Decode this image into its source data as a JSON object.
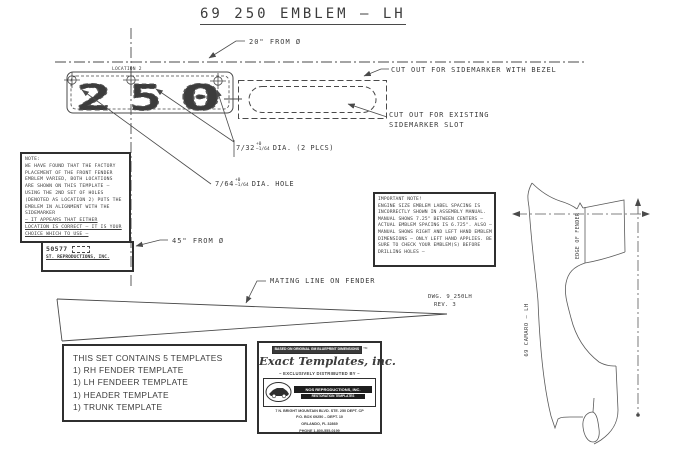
{
  "title": "69 250 EMBLEM  –  LH",
  "labels": {
    "from20": "20\" FROM Ø",
    "from45": "45\" FROM Ø",
    "location": "LOCATION 2",
    "cut_bezel": "CUT OUT FOR SIDEMARKER WITH BEZEL",
    "cut_existing1": "CUT OUT FOR EXISTING",
    "cut_existing2": "SIDEMARKER SLOT",
    "mating": "MATING LINE ON FENDER",
    "edge_of_fender": "EDGE OF FENDER",
    "camaro_lh": "69 CAMARO – LH"
  },
  "digits": {
    "d1": "2",
    "d2": "5",
    "d3": "0"
  },
  "dia2": {
    "frac": "7/32",
    "plus": "+0",
    "minus": "−1/64",
    "rest": "DIA. (2 PLCS)"
  },
  "dia1": {
    "frac": "7/64",
    "plus": "+0",
    "minus": "−1/64",
    "rest": "DIA. HOLE"
  },
  "dwg": {
    "l1": "DWG. 9_250LH",
    "l2": "REV. 3"
  },
  "note": {
    "l0": "NOTE:",
    "l1": "WE HAVE FOUND THAT THE FACTORY",
    "l2": "PLACEMENT OF THE FRONT FENDER",
    "l3": "EMBLEM VARIED, BOTH LOCATIONS",
    "l4": "ARE SHOWN ON THIS TEMPLATE –",
    "l5": "USING THE 2ND SET OF HOLES",
    "l6": "(DENOTED AS LOCATION 2) PUTS THE",
    "l7": "EMBLEM IN ALIGNMENT WITH THE",
    "l8": "SIDEMARKER",
    "l9": "– IT APPEARS THAT EITHER",
    "l10": "LOCATION IS CORRECT – IT IS YOUR",
    "l11": "CHOICE WHICH TO USE –"
  },
  "sticker": {
    "l1": "50577",
    "l2": "ST. REPRODUCTIONS, INC."
  },
  "important": {
    "l0": "IMPORTANT NOTE!",
    "l1": "ENGINE SIZE EMBLEM LABEL SPACING IS",
    "l2": "INCORRECTLY SHOWN IN ASSEMBLY MANUAL.",
    "l3": "MANUAL SHOWS 7.25\" BETWEEN CENTERS –",
    "l4": "ACTUAL EMBLEM SPACING IS 6.725\". ALSO –",
    "l5": "MANUAL SHOWS RIGHT AND LEFT HAND EMBLEM",
    "l6": "DIMENSIONS – ONLY LEFT HAND APPLIES. BE",
    "l7": "SURE TO CHECK YOUR EMBLEM(S) BEFORE",
    "l8": "DRILLING HOLES –"
  },
  "contents": {
    "title": "THIS SET CONTAINS 5 TEMPLATES",
    "i1": "1)  RH FENDER TEMPLATE",
    "i2": "1)  LH FENDEER TEMPLATE",
    "i3": "1)  HEADER TEMPLATE",
    "i4": "1)  TRUNK TEMPLATE"
  },
  "brand": {
    "banner": "BASED ON ORIGINAL GM BLUEPRINT DIMENSIONS",
    "tm": "TM",
    "logo": "Exact Templates, inc.",
    "distributed": "– EXCLUSIVELY DISTRIBUTED BY –",
    "company": "NOS REPRODUCTIONS, INC.",
    "company2": "RESTORATION TEMPLATES",
    "addr1": "7 N. BRIGHT MOUNTAIN BLVD. STE. 250 DEPT. CP",
    "addr2": "P.O. BOX 69250 – DEPT. 10",
    "addr3": "ORLANDO, FL 32869",
    "addr4": "PHONE 1-800-555-0199"
  }
}
